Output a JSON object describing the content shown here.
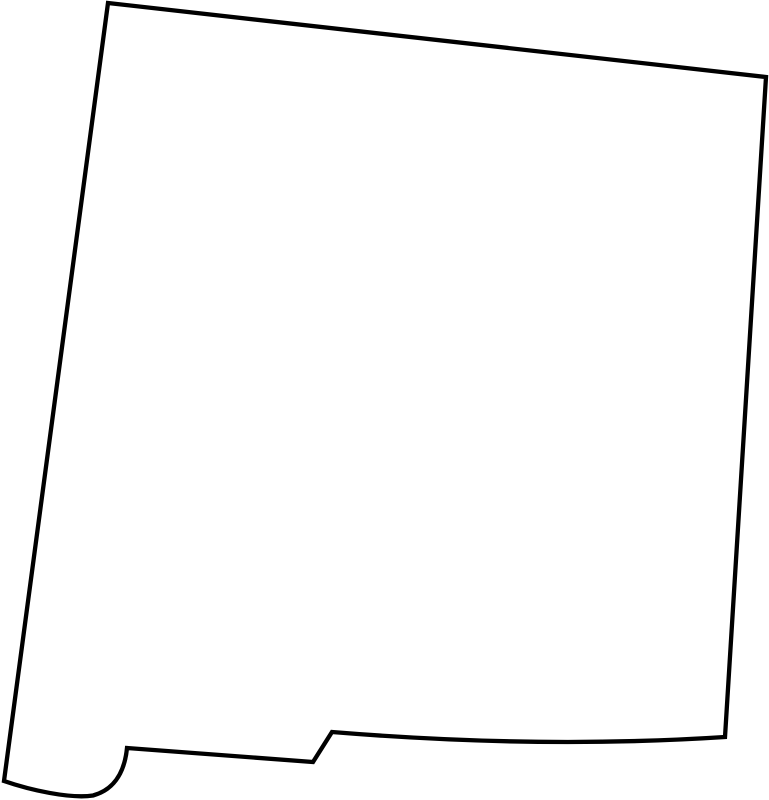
{
  "page": {
    "width_px": 769,
    "height_px": 800,
    "background_color": "#ffffff"
  },
  "map": {
    "name": "new-mexico-state-outline",
    "label": "Blank outline map of New Mexico",
    "stroke_color": "#000000",
    "fill_color": "#ffffff",
    "stroke_width_px": 4.3,
    "outline_path": "M 108 3 L 766 77 L 725 737 Q 540 749 332 732 L 313 762 L 127 748 C 125 768 117 789 93 795.5 C 70 799 30 790 4 781 Z"
  }
}
